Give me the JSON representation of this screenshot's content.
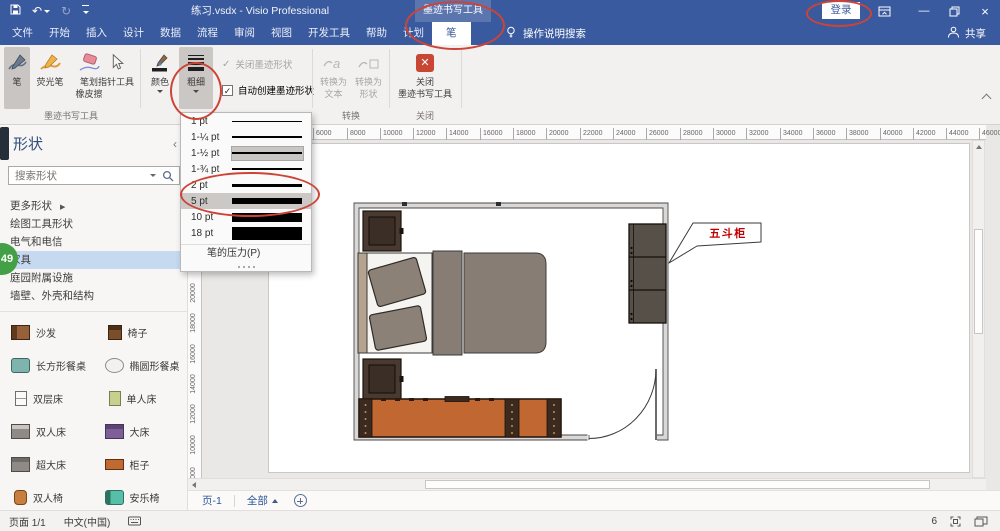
{
  "titlebar": {
    "title": "练习.vsdx  -  Visio Professional",
    "contextual_tab": "墨迹书写工具",
    "signin": "登录"
  },
  "tabrow": {
    "tellme": "操作说明搜索",
    "share": "共享",
    "tabs": [
      {
        "label": "文件"
      },
      {
        "label": "开始"
      },
      {
        "label": "插入"
      },
      {
        "label": "设计"
      },
      {
        "label": "数据"
      },
      {
        "label": "流程"
      },
      {
        "label": "审阅"
      },
      {
        "label": "视图"
      },
      {
        "label": "开发工具"
      },
      {
        "label": "帮助"
      },
      {
        "label": "计划"
      },
      {
        "label": "笔",
        "cls": "active"
      }
    ]
  },
  "ribbon": {
    "pen": "笔",
    "highlighter": "荧光笔",
    "eraser_l1": "笔划",
    "eraser_l2": "橡皮擦",
    "pointer": "指针工具",
    "color": "颜色",
    "thickness": "粗细",
    "chk_close_ink": "关闭墨迹形状",
    "chk_auto_create": "自动创建墨迹形状",
    "cvt_text_l1": "转换为",
    "cvt_text_l2": "文本",
    "cvt_shape_l1": "转换为",
    "cvt_shape_l2": "形状",
    "close_l1": "关闭",
    "close_l2": "墨迹书写工具",
    "group_ink_label": "墨迹书写工具",
    "group_convert_label": "转换",
    "group_close_label": "关闭"
  },
  "dropdown": {
    "footer": "笔的压力(P)",
    "items": [
      {
        "label": "1 pt",
        "h": 1
      },
      {
        "label": "1-¼ pt",
        "h": 1.5
      },
      {
        "label": "1-½ pt",
        "h": 2.5,
        "cls": "sel"
      },
      {
        "label": "1-¾ pt",
        "h": 1.5
      },
      {
        "label": "2 pt",
        "h": 3
      },
      {
        "label": "5 pt",
        "h": 6,
        "cls": "hov"
      },
      {
        "label": "10 pt",
        "h": 9
      },
      {
        "label": "18 pt",
        "h": 13
      }
    ]
  },
  "panel": {
    "title": "形状",
    "search_placeholder": "搜索形状",
    "sections": [
      {
        "label": "更多形状",
        "arrow": "▶"
      },
      {
        "label": "绘图工具形状"
      },
      {
        "label": "电气和电信"
      },
      {
        "label": "家具",
        "cls": "selected"
      },
      {
        "label": "庭园附属设施"
      },
      {
        "label": "墙壁、外壳和结构"
      }
    ],
    "stencil": [
      {
        "label": "沙发",
        "icon": "ic-sofa"
      },
      {
        "label": "椅子",
        "icon": "ic-chair"
      },
      {
        "label": "长方形餐桌",
        "icon": "ic-trect"
      },
      {
        "label": "椭圆形餐桌",
        "icon": "ic-toval"
      },
      {
        "label": "双层床",
        "icon": "ic-bunk"
      },
      {
        "label": "单人床",
        "icon": "ic-single"
      },
      {
        "label": "双人床",
        "icon": "ic-double"
      },
      {
        "label": "大床",
        "icon": "ic-big"
      },
      {
        "label": "超大床",
        "icon": "ic-xl"
      },
      {
        "label": "柜子",
        "icon": "ic-cab"
      },
      {
        "label": "双人椅",
        "icon": "ic-love"
      },
      {
        "label": "安乐椅",
        "icon": "ic-easy"
      }
    ]
  },
  "canvas": {
    "callout_label": "五斗柜",
    "h_ruler": [
      {
        "label": "4000",
        "x": 92
      },
      {
        "label": "6000",
        "x": 125
      },
      {
        "label": "8000",
        "x": 159
      },
      {
        "label": "10000",
        "x": 192
      },
      {
        "label": "12000",
        "x": 225
      },
      {
        "label": "14000",
        "x": 258
      },
      {
        "label": "16000",
        "x": 292
      },
      {
        "label": "18000",
        "x": 325
      },
      {
        "label": "20000",
        "x": 358
      },
      {
        "label": "22000",
        "x": 392
      },
      {
        "label": "24000",
        "x": 425
      },
      {
        "label": "26000",
        "x": 458
      },
      {
        "label": "28000",
        "x": 492
      },
      {
        "label": "30000",
        "x": 525
      },
      {
        "label": "32000",
        "x": 558
      },
      {
        "label": "34000",
        "x": 592
      },
      {
        "label": "36000",
        "x": 625
      },
      {
        "label": "38000",
        "x": 658
      },
      {
        "label": "40000",
        "x": 692
      },
      {
        "label": "42000",
        "x": 725
      },
      {
        "label": "44000",
        "x": 758
      },
      {
        "label": "46000",
        "x": 791
      }
    ],
    "v_ruler": [
      {
        "label": "20000",
        "y": 148
      },
      {
        "label": "18000",
        "y": 178
      },
      {
        "label": "16000",
        "y": 209
      },
      {
        "label": "14000",
        "y": 239
      },
      {
        "label": "12000",
        "y": 269
      },
      {
        "label": "10000",
        "y": 300
      },
      {
        "label": "8000",
        "y": 330
      }
    ]
  },
  "pagebar": {
    "page1": "页-1",
    "all": "全部"
  },
  "statusbar": {
    "page_info": "页面 1/1",
    "language": "中文(中国)",
    "zoom_text": "6"
  },
  "badge": "49",
  "colors": {
    "accent": "#3A5A9F",
    "annotation": "#CD4437",
    "badge_green": "#43A047",
    "callout_red": "#C00000"
  }
}
